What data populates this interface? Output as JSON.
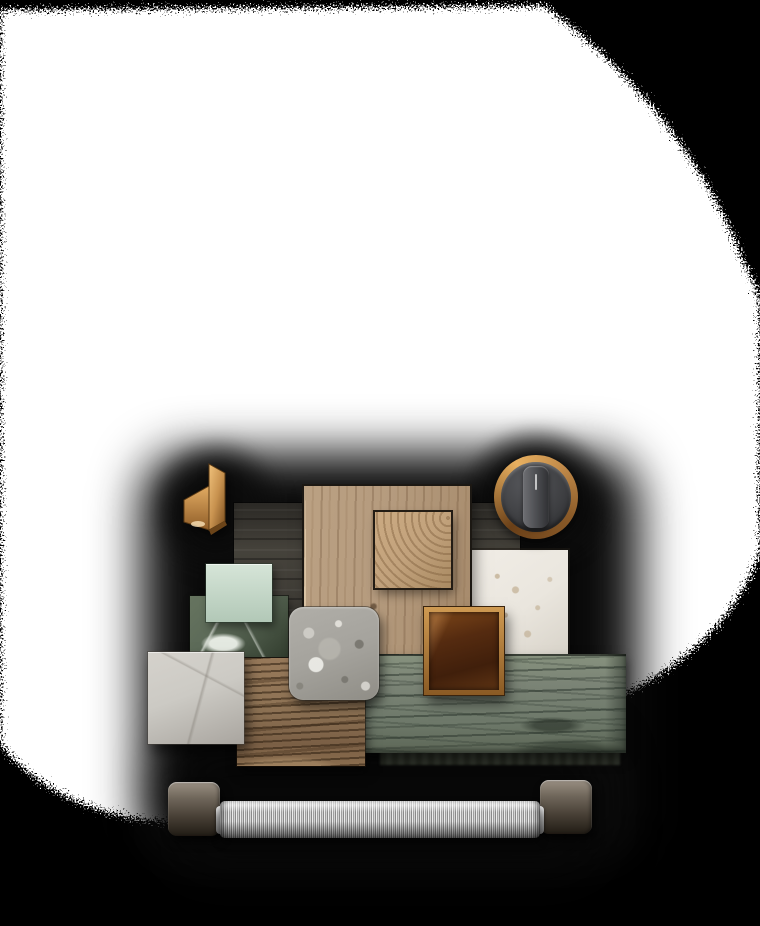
{
  "scene": {
    "kind": "materials-moodboard-flatlay",
    "background": "black with white dithered spotlight blob",
    "text_content": "none"
  },
  "colors": {
    "page_bg": "#000000",
    "spotlight": "#ffffff",
    "shadow": "#0b0b0b",
    "panel": "#45423b",
    "panel_dark": "#2b2925",
    "oak": "#b59b7e",
    "oak_edge": "#d9c3a4",
    "endgrain": "#c2a27c",
    "brass_light": "#f0c27c",
    "brass": "#c8924f",
    "brass_dark": "#7c4f1f",
    "knob_ring_light": "#e8b060",
    "knob_ring_dark": "#6a4018",
    "knob_face": "#3f4043",
    "knob_grip_light": "#6e6f73",
    "knob_grip_dark": "#2f3033",
    "mint_light": "#d6e5d8",
    "mint_dark": "#b2c8b7",
    "marble_green": "#5c6a58",
    "marble_green_dark": "#323d2e",
    "marble_vein": "#e4e9e1",
    "terrazzo": "#a5a39d",
    "terrazzo_light": "#cdcbc5",
    "terrazzo_dark": "#7b7972",
    "travertine": "#eae6de",
    "travertine_speck": "#a98e66",
    "copper_frame_light": "#cf9a52",
    "copper_frame_dark": "#8a5a24",
    "copper_glass": "#401f0b",
    "copper_glass_light": "#7c4619",
    "plank": "#7b8476",
    "plank_line": "#39443a",
    "ribbed": "#8e7355",
    "ribbed_line": "#4a3623",
    "marble_gray": "#cccac4",
    "marble_gray_dark": "#a9a59f",
    "steel_light": "#ebebeb",
    "steel_mid": "#9f9f9f",
    "steel_dark": "#8a8a8a",
    "cap_light": "#9a9083",
    "cap_mid": "#6f665a",
    "cap_dark": "#211c15"
  },
  "items": {
    "spotlight": {
      "label": "White spotlight blob with dithered edge"
    },
    "cluster_shadow": {
      "label": "Soft dark shadow behind material cluster"
    },
    "backdrop_panel": {
      "label": "Dark smoked-wood backdrop panel"
    },
    "brass_bracket": {
      "label": "Folded brass hardware sample"
    },
    "metal_knob": {
      "label": "Gunmetal control knob with copper rim and vertical grip"
    },
    "oak_board": {
      "label": "Light oak board with vertical grain"
    },
    "oak_endgrain": {
      "label": "Oak end-grain block"
    },
    "mint_tile": {
      "label": "Pale mint glass tile"
    },
    "green_marble": {
      "label": "Green marble slab with white veining"
    },
    "terrazzo_tile": {
      "label": "Grey terrazzo tile with rounded corners"
    },
    "travertine_tile": {
      "label": "White travertine tile with beige specks"
    },
    "copper_tile": {
      "label": "Amber lacquered copper-framed tile"
    },
    "green_plank": {
      "label": "Grey-green stained wood plank"
    },
    "grain_wood": {
      "label": "Brown wood sample with pronounced grain"
    },
    "grey_marble": {
      "label": "Light grey marble tile"
    },
    "pull_handle": {
      "label": "Knurled steel pull handle with dark metal end caps"
    }
  }
}
